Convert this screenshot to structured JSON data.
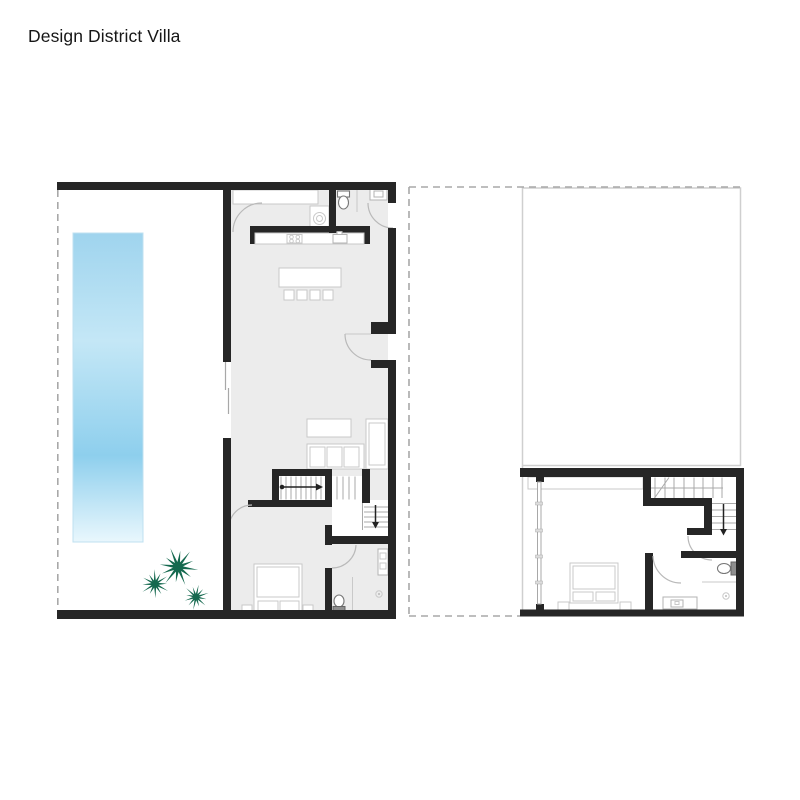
{
  "page": {
    "title": "Design District Villa"
  },
  "colors": {
    "wall": "#262626",
    "interior_floor": "#ececec",
    "pool_top": "#9fd4ee",
    "pool_mid": "#c4e7f6",
    "pool_deep": "#8ecfed",
    "pool_fade": "#e9f7fd",
    "palm_green": "#15694f",
    "thin_line": "#c9c9c9",
    "dash_line": "#a8a8a8",
    "stair_arrow": "#222222"
  },
  "plans": {
    "left": {
      "fixtures": [
        "pool",
        "palm-trees",
        "kitchen-counter",
        "cooktop",
        "kitchen-sink",
        "washer",
        "island-with-stools",
        "powder-room-toilet",
        "powder-room-sink",
        "sofa",
        "coffee-table",
        "staircase",
        "bed",
        "nightstands",
        "bathroom-toilet",
        "bathroom-sink",
        "shower"
      ]
    },
    "right": {
      "fixtures": [
        "roof-void-outline",
        "footprint-dashed-outline",
        "wardrobe",
        "window-wall",
        "staircase",
        "bed",
        "nightstands",
        "toilet",
        "vanity-sink",
        "shower"
      ]
    }
  }
}
